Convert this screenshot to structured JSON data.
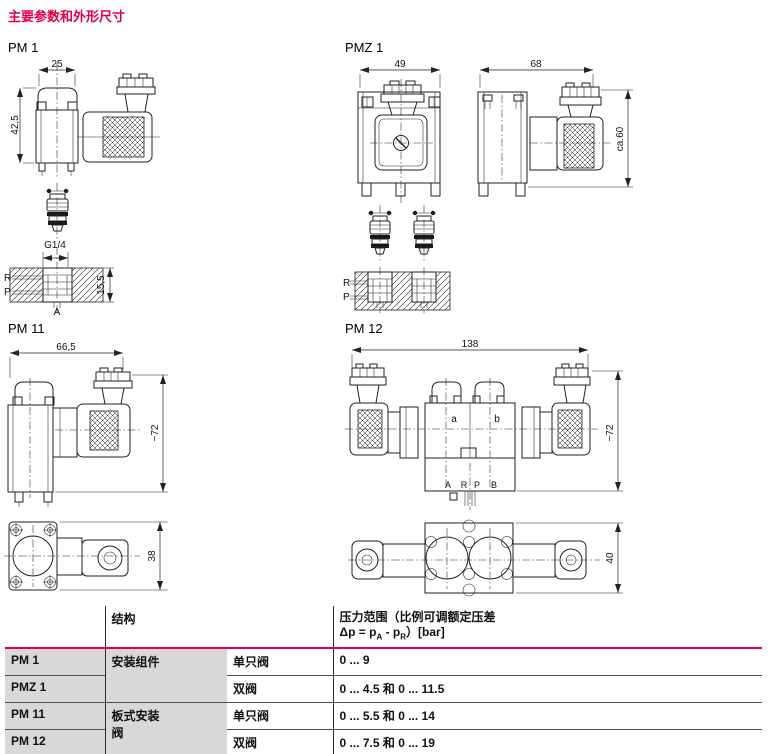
{
  "title": "主要参数和外形尺寸",
  "accent_color": "#e50043",
  "drawings": {
    "pm1": {
      "label": "PM 1",
      "dim_width": "25",
      "dim_height": "42,5",
      "thread": "G1/4",
      "dim_depth": "15,5",
      "port_r": "R",
      "port_p": "P",
      "port_a": "A"
    },
    "pmz1": {
      "label": "PMZ 1",
      "dim_front_width": "49",
      "dim_side_width": "68",
      "dim_height": "ca.60",
      "port_r": "R",
      "port_p": "P"
    },
    "pm11": {
      "label": "PM 11",
      "dim_width": "66,5",
      "dim_height": "~72",
      "dim_top_height": "38"
    },
    "pm12": {
      "label": "PM 12",
      "dim_width": "138",
      "dim_height": "~72",
      "dim_top_height": "40",
      "valve_a": "a",
      "valve_b": "b",
      "port_a": "A",
      "port_r": "R",
      "port_p": "P",
      "port_b": "B"
    }
  },
  "table": {
    "header": {
      "structure": "结构",
      "pressure_l1": "压力范围（比例可调额定压差",
      "dp_prefix": "Δp = p",
      "dp_sub_a": "A",
      "dp_mid": " - p",
      "dp_sub_r": "R",
      "dp_suffix": "）[bar]"
    },
    "rows": [
      {
        "model": "PM 1",
        "structure_l1": "安装组件",
        "config": "单只阀",
        "range": "0 ... 9"
      },
      {
        "model": "PMZ 1",
        "config": "双阀",
        "range": "0 ... 4.5 和 0 ... 11.5"
      },
      {
        "model": "PM 11",
        "structure_l1": "板式安装",
        "structure_l2": "阀",
        "config": "单只阀",
        "range": "0 ... 5.5 和 0 ... 14"
      },
      {
        "model": "PM 12",
        "config": "双阀",
        "range": "0 ... 7.5 和 0 ... 19"
      }
    ]
  }
}
